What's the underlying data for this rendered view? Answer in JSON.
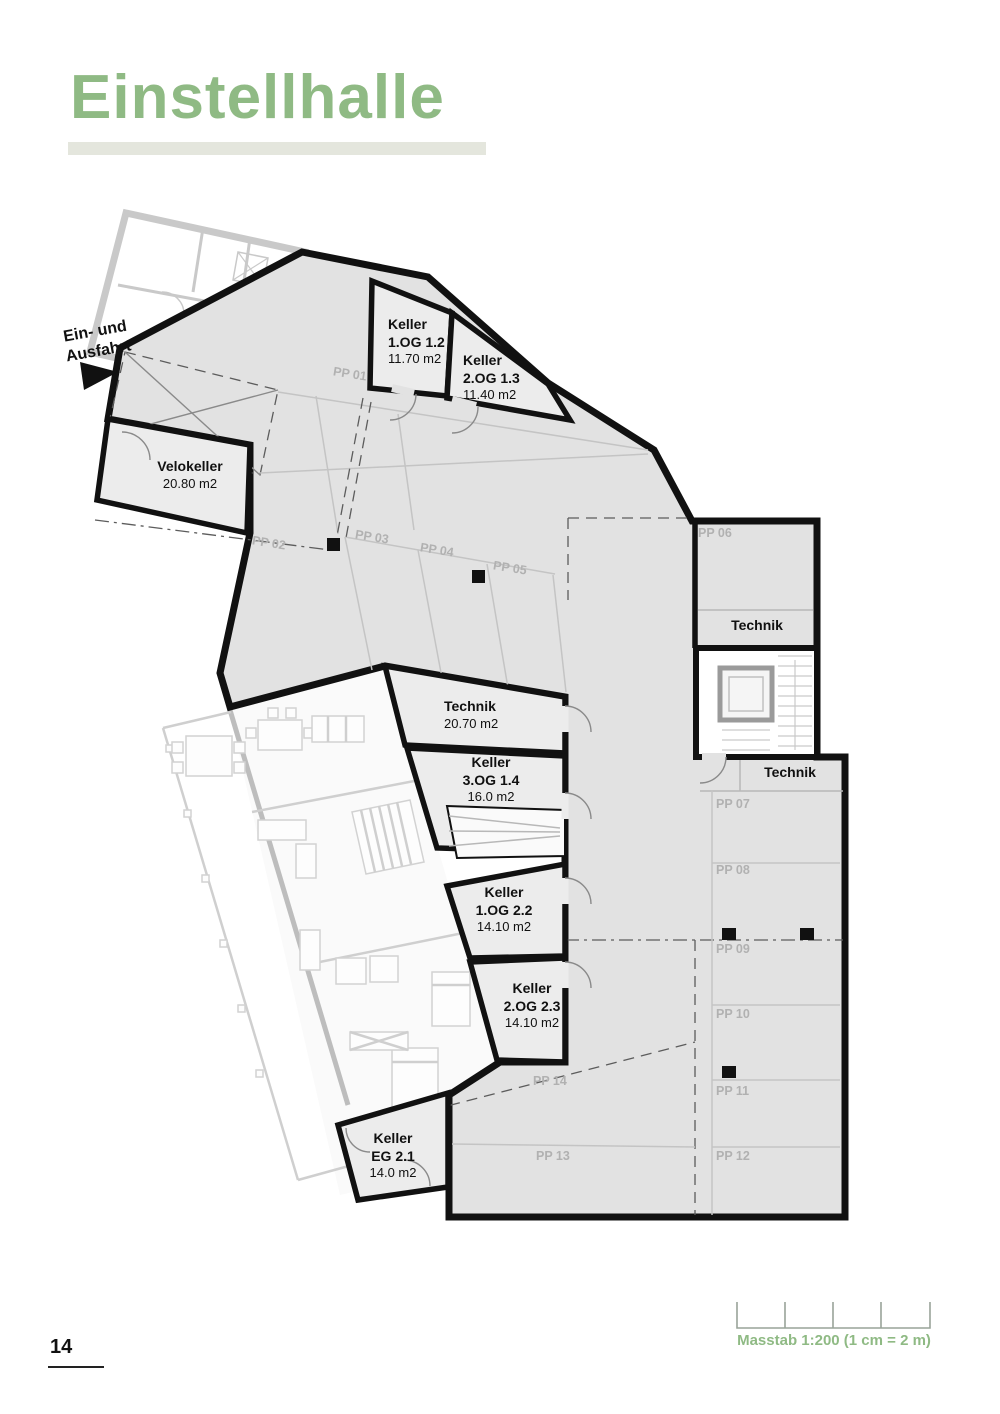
{
  "page": {
    "title": "Einstellhalle",
    "page_number": "14"
  },
  "scale": {
    "label": "Masstab 1:200 (1 cm = 2 m)"
  },
  "entrance": {
    "line1": "Ein- und",
    "line2": "Ausfahrt"
  },
  "rooms": {
    "velokeller": {
      "name": "Velokeller",
      "area": "20.80 m2"
    },
    "keller_1og_12": {
      "name": "Keller",
      "unit": "1.OG 1.2",
      "area": "11.70 m2"
    },
    "keller_2og_13": {
      "name": "Keller",
      "unit": "2.OG 1.3",
      "area": "11.40 m2"
    },
    "technik_mid": {
      "name": "Technik",
      "area": "20.70 m2"
    },
    "keller_3og_14": {
      "name": "Keller",
      "unit": "3.OG 1.4",
      "area": "16.0 m2"
    },
    "keller_1og_22": {
      "name": "Keller",
      "unit": "1.OG 2.2",
      "area": "14.10 m2"
    },
    "keller_2og_23": {
      "name": "Keller",
      "unit": "2.OG 2.3",
      "area": "14.10 m2"
    },
    "keller_eg_21": {
      "name": "Keller",
      "unit": "EG 2.1",
      "area": "14.0 m2"
    },
    "technik_ne": {
      "name": "Technik"
    },
    "technik_e": {
      "name": "Technik"
    }
  },
  "parking": {
    "spots": [
      "PP 01",
      "PP 02",
      "PP 03",
      "PP 04",
      "PP 05",
      "PP 06",
      "PP 07",
      "PP 08",
      "PP 09",
      "PP 10",
      "PP 11",
      "PP 12",
      "PP 13",
      "PP 14"
    ]
  },
  "colors": {
    "accent": "#8fba84",
    "bar": "#e4e6dd",
    "floor": "#e2e2e2",
    "room": "#ececec",
    "wall": "#111111",
    "label_gray": "#b1b1b1",
    "line_gray": "#c4c4c4",
    "overlay_gray": "#c9c9c9"
  }
}
